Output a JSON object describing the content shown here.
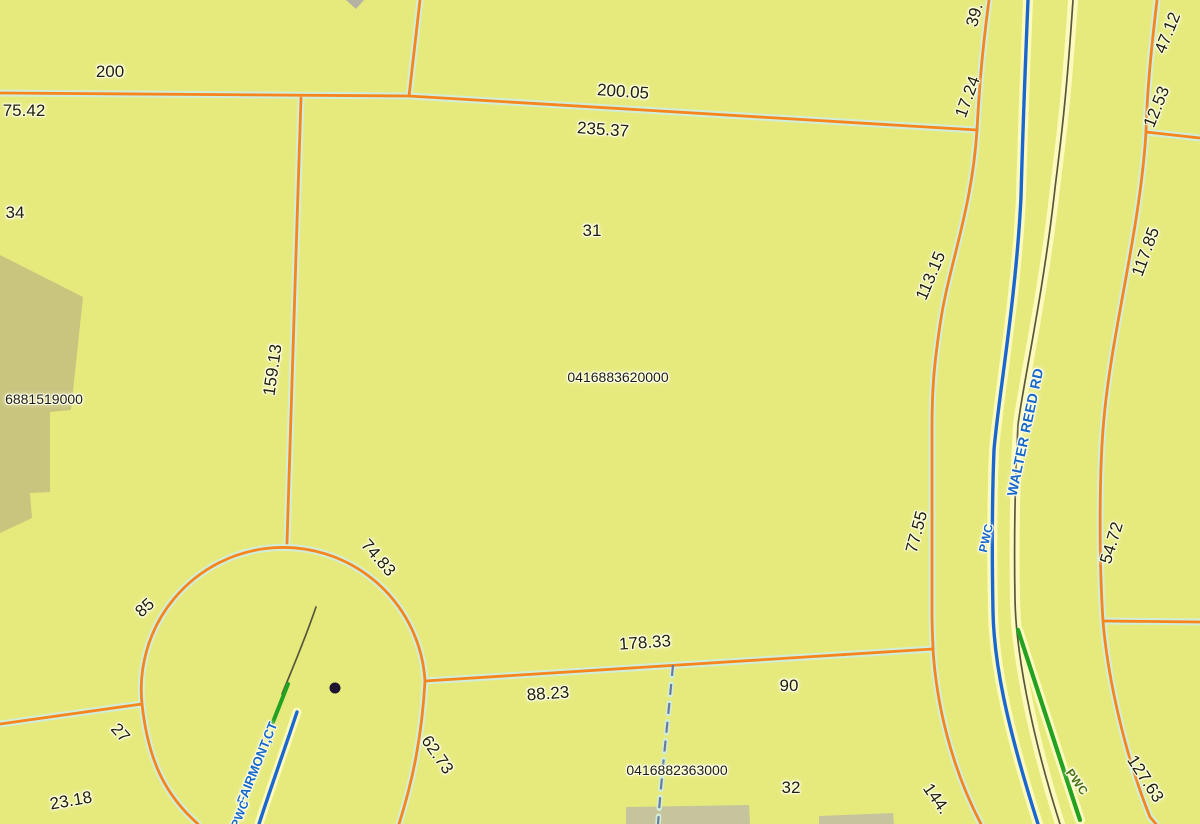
{
  "map": {
    "description_labels": {
      "parcel_ids": [
        "0416883620000",
        "0416882363000",
        "6881519000"
      ],
      "parcel_numbers": [
        "31",
        "32"
      ],
      "road_names": [
        "WALTER REED RD",
        "FAIRMONT,CT"
      ],
      "utility_labels": [
        "PWC",
        "PWC",
        "PWC"
      ],
      "dimensions": [
        "200",
        "75.42",
        "34",
        "200.05",
        "235.37",
        "159.13",
        "39.",
        "17.24",
        "47.12",
        "12.53",
        "113.15",
        "117.85",
        "77.55",
        "54.72",
        "74.83",
        "85",
        "27",
        "23.18",
        "178.33",
        "88.23",
        "90",
        "62.73",
        "144.",
        "127.63"
      ]
    },
    "colors": {
      "background": "#e6ea7c",
      "parcel_line": "#f6851d",
      "parcel_line_halo": "#d2eed8",
      "road_fill": "#fdfabe",
      "stream_blue": "#1a67d2",
      "centerline_dark": "#57573c",
      "utility_green": "#23a122",
      "dashed_boundary": "#6a7a9c",
      "building_fill": "#c9c57f",
      "building_fill_gray": "#c6c49c",
      "road_label_blue": "#1668cc",
      "pwc_green_text": "#4a7214",
      "dimension_text": "#20200a"
    },
    "labels": [
      {
        "name": "dim-200",
        "text": "200",
        "x": 110,
        "y": 72,
        "rot": 0,
        "cls": "lbl-dim"
      },
      {
        "name": "dim-75-42",
        "text": "75.42",
        "x": 24,
        "y": 111,
        "rot": 0,
        "cls": "lbl-dim"
      },
      {
        "name": "dim-34",
        "text": "34",
        "x": 15,
        "y": 213,
        "rot": 0,
        "cls": "lbl-dim"
      },
      {
        "name": "dim-200-05",
        "text": "200.05",
        "x": 623,
        "y": 92,
        "rot": 4,
        "cls": "lbl-dim"
      },
      {
        "name": "dim-235-37",
        "text": "235.37",
        "x": 603,
        "y": 130,
        "rot": 4,
        "cls": "lbl-dim"
      },
      {
        "name": "parcel-num-31",
        "text": "31",
        "x": 592,
        "y": 231,
        "rot": 0,
        "cls": "lbl-pnum"
      },
      {
        "name": "parcel-id-0416883620000",
        "text": "0416883620000",
        "x": 618,
        "y": 377,
        "rot": 0,
        "cls": "lbl-pid"
      },
      {
        "name": "dim-159-13",
        "text": "159.13",
        "x": 273,
        "y": 370,
        "rot": -82,
        "cls": "lbl-dim"
      },
      {
        "name": "dim-39",
        "text": "39.",
        "x": 975,
        "y": 15,
        "rot": -75,
        "cls": "lbl-dim"
      },
      {
        "name": "dim-17-24",
        "text": "17.24",
        "x": 968,
        "y": 97,
        "rot": -70,
        "cls": "lbl-dim"
      },
      {
        "name": "dim-47-12",
        "text": "47.12",
        "x": 1168,
        "y": 33,
        "rot": -68,
        "cls": "lbl-dim"
      },
      {
        "name": "dim-12-53",
        "text": "12.53",
        "x": 1157,
        "y": 107,
        "rot": -68,
        "cls": "lbl-dim"
      },
      {
        "name": "dim-113-15",
        "text": "113.15",
        "x": 931,
        "y": 276,
        "rot": -67,
        "cls": "lbl-dim"
      },
      {
        "name": "dim-117-85",
        "text": "117.85",
        "x": 1146,
        "y": 252,
        "rot": -70,
        "cls": "lbl-dim"
      },
      {
        "name": "road-walter-reed-rd",
        "text": "WALTER REED RD",
        "x": 1025,
        "y": 432,
        "rot": -78,
        "cls": "lbl-road"
      },
      {
        "name": "utility-pwc-blue",
        "text": "PWC",
        "x": 986,
        "y": 538,
        "rot": -77,
        "cls": "lbl-pwc-b"
      },
      {
        "name": "dim-77-55",
        "text": "77.55",
        "x": 917,
        "y": 532,
        "rot": -75,
        "cls": "lbl-dim"
      },
      {
        "name": "dim-54-72",
        "text": "54.72",
        "x": 1112,
        "y": 543,
        "rot": -73,
        "cls": "lbl-dim"
      },
      {
        "name": "dim-74-83",
        "text": "74.83",
        "x": 378,
        "y": 558,
        "rot": 49,
        "cls": "lbl-dim"
      },
      {
        "name": "dim-85",
        "text": "85",
        "x": 145,
        "y": 608,
        "rot": -42,
        "cls": "lbl-dim"
      },
      {
        "name": "dim-27",
        "text": "27",
        "x": 120,
        "y": 733,
        "rot": 48,
        "cls": "lbl-dim"
      },
      {
        "name": "dim-23-18",
        "text": "23.18",
        "x": 71,
        "y": 801,
        "rot": -10,
        "cls": "lbl-dim"
      },
      {
        "name": "dim-178-33",
        "text": "178.33",
        "x": 645,
        "y": 643,
        "rot": -4,
        "cls": "lbl-dim"
      },
      {
        "name": "dim-88-23",
        "text": "88.23",
        "x": 548,
        "y": 694,
        "rot": -4,
        "cls": "lbl-dim"
      },
      {
        "name": "dim-90",
        "text": "90",
        "x": 789,
        "y": 686,
        "rot": 0,
        "cls": "lbl-dim"
      },
      {
        "name": "dim-62-73",
        "text": "62.73",
        "x": 437,
        "y": 755,
        "rot": 55,
        "cls": "lbl-dim"
      },
      {
        "name": "parcel-id-0416882363000",
        "text": "0416882363000",
        "x": 677,
        "y": 770,
        "rot": 0,
        "cls": "lbl-pid"
      },
      {
        "name": "parcel-num-32",
        "text": "32",
        "x": 791,
        "y": 788,
        "rot": 0,
        "cls": "lbl-pnum"
      },
      {
        "name": "dim-144",
        "text": "144.",
        "x": 936,
        "y": 799,
        "rot": 55,
        "cls": "lbl-dim"
      },
      {
        "name": "dim-127-63",
        "text": "127.63",
        "x": 1145,
        "y": 779,
        "rot": 57,
        "cls": "lbl-dim"
      },
      {
        "name": "utility-pwc-green",
        "text": "PWC",
        "x": 1077,
        "y": 782,
        "rot": 55,
        "cls": "lbl-pwc-g"
      },
      {
        "name": "road-fairmont-ct",
        "text": "FAIRMONT,CT",
        "x": 257,
        "y": 763,
        "rot": -68,
        "cls": "lbl-road-sm"
      },
      {
        "name": "utility-pwc-blue-2",
        "text": "PWC",
        "x": 240,
        "y": 814,
        "rot": -68,
        "cls": "lbl-pwc-b"
      },
      {
        "name": "parcel-id-6881519000",
        "text": "6881519000",
        "x": 44,
        "y": 399,
        "rot": 0,
        "cls": "lbl-pid"
      }
    ]
  }
}
